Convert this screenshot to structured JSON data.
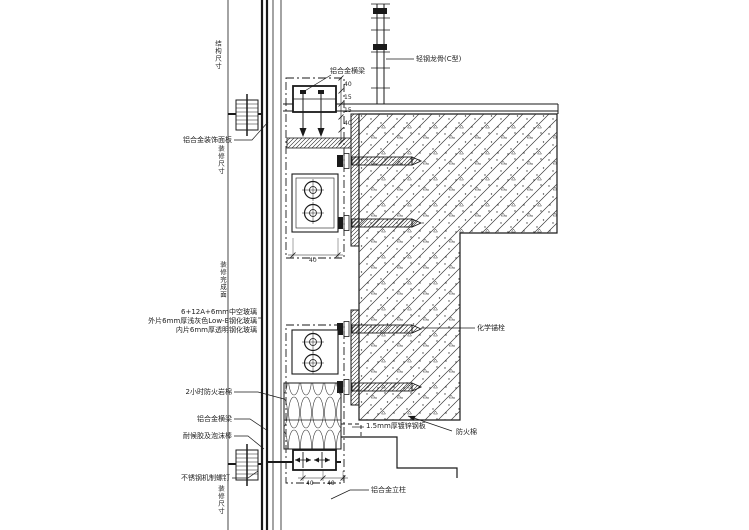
{
  "meta": {
    "background_color": "#ffffff",
    "line_color": "#1a1a1a",
    "text_color": "#222222",
    "drawing_type": "curtain-wall-section-detail"
  },
  "labels": [
    {
      "name": "ref-structure-dim",
      "text": "结构尺寸"
    },
    {
      "name": "ref-finish-dim",
      "text": "装修尺寸"
    },
    {
      "name": "decorative-panel",
      "text": "铝合金装饰面板"
    },
    {
      "name": "steel-stud",
      "text": "轻钢龙骨(C型)"
    },
    {
      "name": "transom-top",
      "text": "铝合金横梁"
    },
    {
      "name": "glass-line-1",
      "text": "6+12A+6mm中空玻璃"
    },
    {
      "name": "glass-line-2",
      "text": "外片6mm厚浅灰色Low-E钢化玻璃"
    },
    {
      "name": "glass-line-3",
      "text": "内片6mm厚透明钢化玻璃"
    },
    {
      "name": "ref-finish-face",
      "text": "装修完成面"
    },
    {
      "name": "chemical-anchor",
      "text": "化学锚栓"
    },
    {
      "name": "rock-wool",
      "text": "2小时防火岩棉"
    },
    {
      "name": "transom-bottom",
      "text": "铝合金横梁"
    },
    {
      "name": "sealant-backer-rod",
      "text": "耐候胶及泡沫棒"
    },
    {
      "name": "galvanized-sheet",
      "text": "1.5mm厚镀锌钢板"
    },
    {
      "name": "fire-cotton",
      "text": "防火棉"
    },
    {
      "name": "machine-screw",
      "text": "不锈钢机制螺钉"
    },
    {
      "name": "ref-finish-dim-2",
      "text": "装修尺寸"
    },
    {
      "name": "mullion",
      "text": "铝合金立柱"
    }
  ],
  "dims": [
    {
      "text": "40"
    },
    {
      "text": "15"
    },
    {
      "text": "15"
    },
    {
      "text": "40"
    },
    {
      "text": "40"
    },
    {
      "text": "40"
    },
    {
      "text": "40"
    }
  ]
}
